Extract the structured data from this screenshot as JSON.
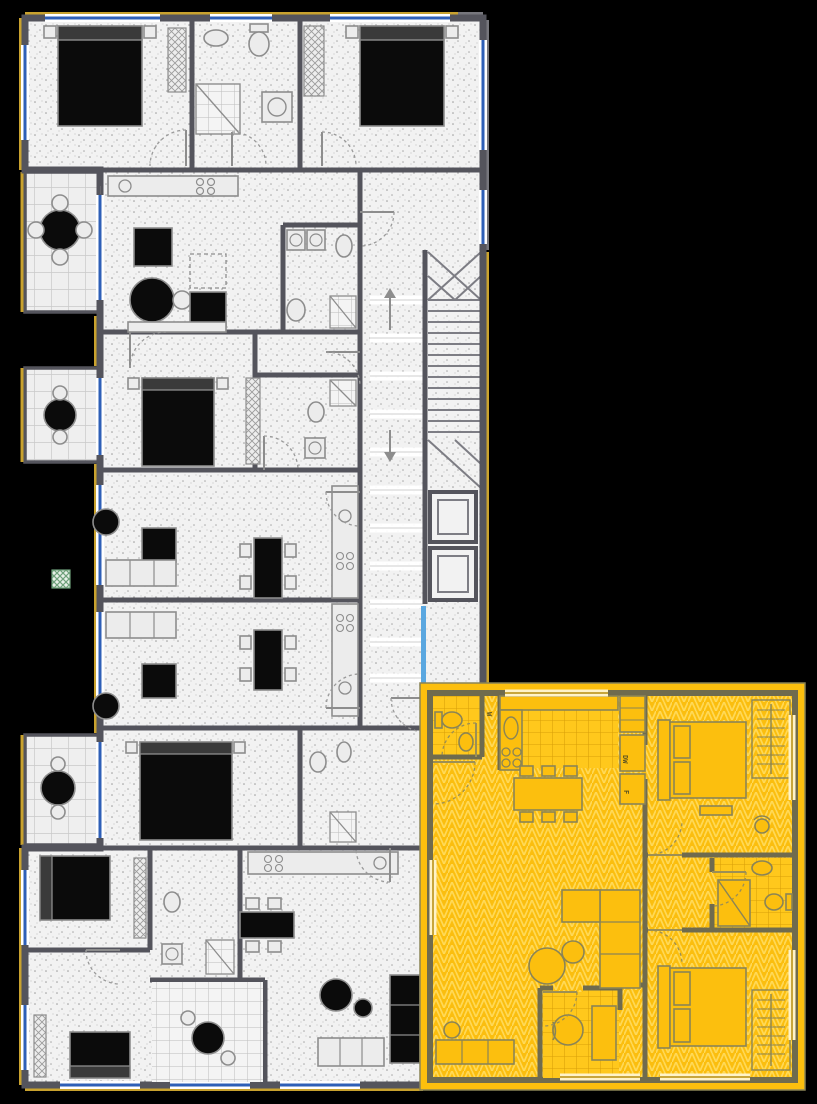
{
  "scene": {
    "type": "architectural-floor-plan",
    "description": "multi-unit residential floor plan on black background with one apartment highlighted in yellow"
  },
  "labels": {
    "washer": "W",
    "dishwasher": "DW",
    "fridge": "F"
  },
  "colors": {
    "background": "#000000",
    "floor": "#f2f2f2",
    "wall": "#54545c",
    "wall_olive": "#6f6b4e",
    "insulation": "#c9a22e",
    "highlight": "#fcbf0e",
    "highlight_line": "#ffd957",
    "highlight_grid": "#d99f08",
    "window_blue": "#2e5fb7",
    "glass_cyan": "#5aa7e0",
    "furniture_dark": "#0b0b0b",
    "furniture_line": "#8d8d8d",
    "accent_green": "#6fa07a"
  }
}
